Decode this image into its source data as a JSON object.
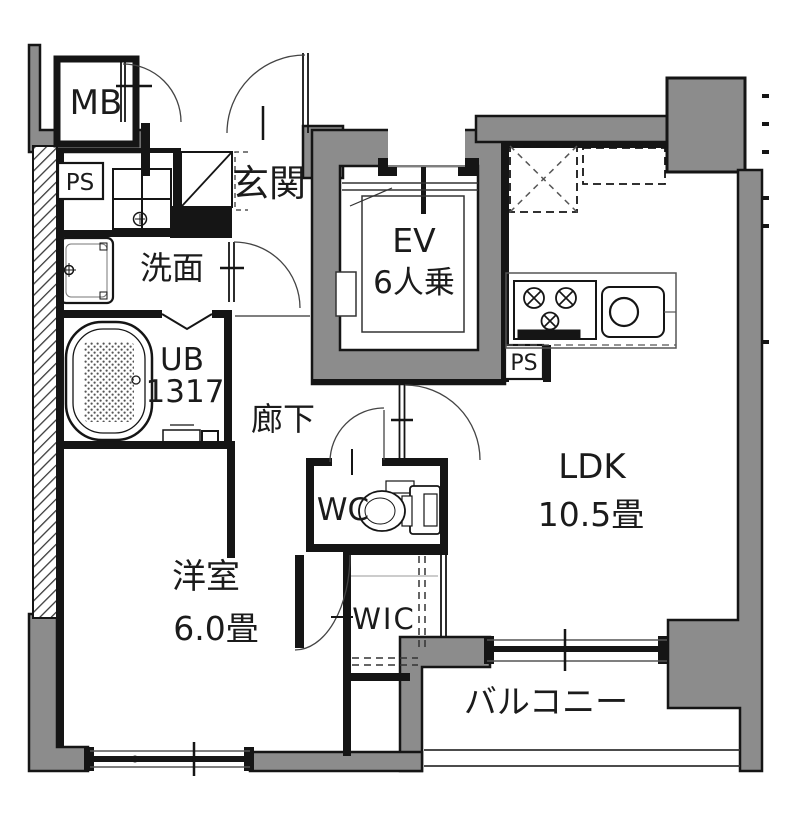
{
  "floorplan": {
    "colors": {
      "wall_gray": "#8c8c8c",
      "line_black": "#151515",
      "background": "#ffffff"
    },
    "rooms": {
      "meter_box": {
        "label": "MB"
      },
      "pipe_space_left": {
        "label": "PS"
      },
      "entrance": {
        "label": "玄関"
      },
      "washroom": {
        "label": "洗面"
      },
      "unit_bath": {
        "label": "UB",
        "size": "1317"
      },
      "corridor": {
        "label": "廊下"
      },
      "elevator": {
        "label": "EV",
        "capacity": "6人乗"
      },
      "pipe_space_kitchen": {
        "label": "PS"
      },
      "toilet_room": {
        "label": "WC"
      },
      "living_dining_kitchen": {
        "label": "LDK",
        "size": "10.5畳"
      },
      "walk_in_closet": {
        "label": "WIC"
      },
      "western_room": {
        "label": "洋室",
        "size": "6.0畳"
      },
      "balcony": {
        "label": "バルコニー"
      }
    }
  }
}
